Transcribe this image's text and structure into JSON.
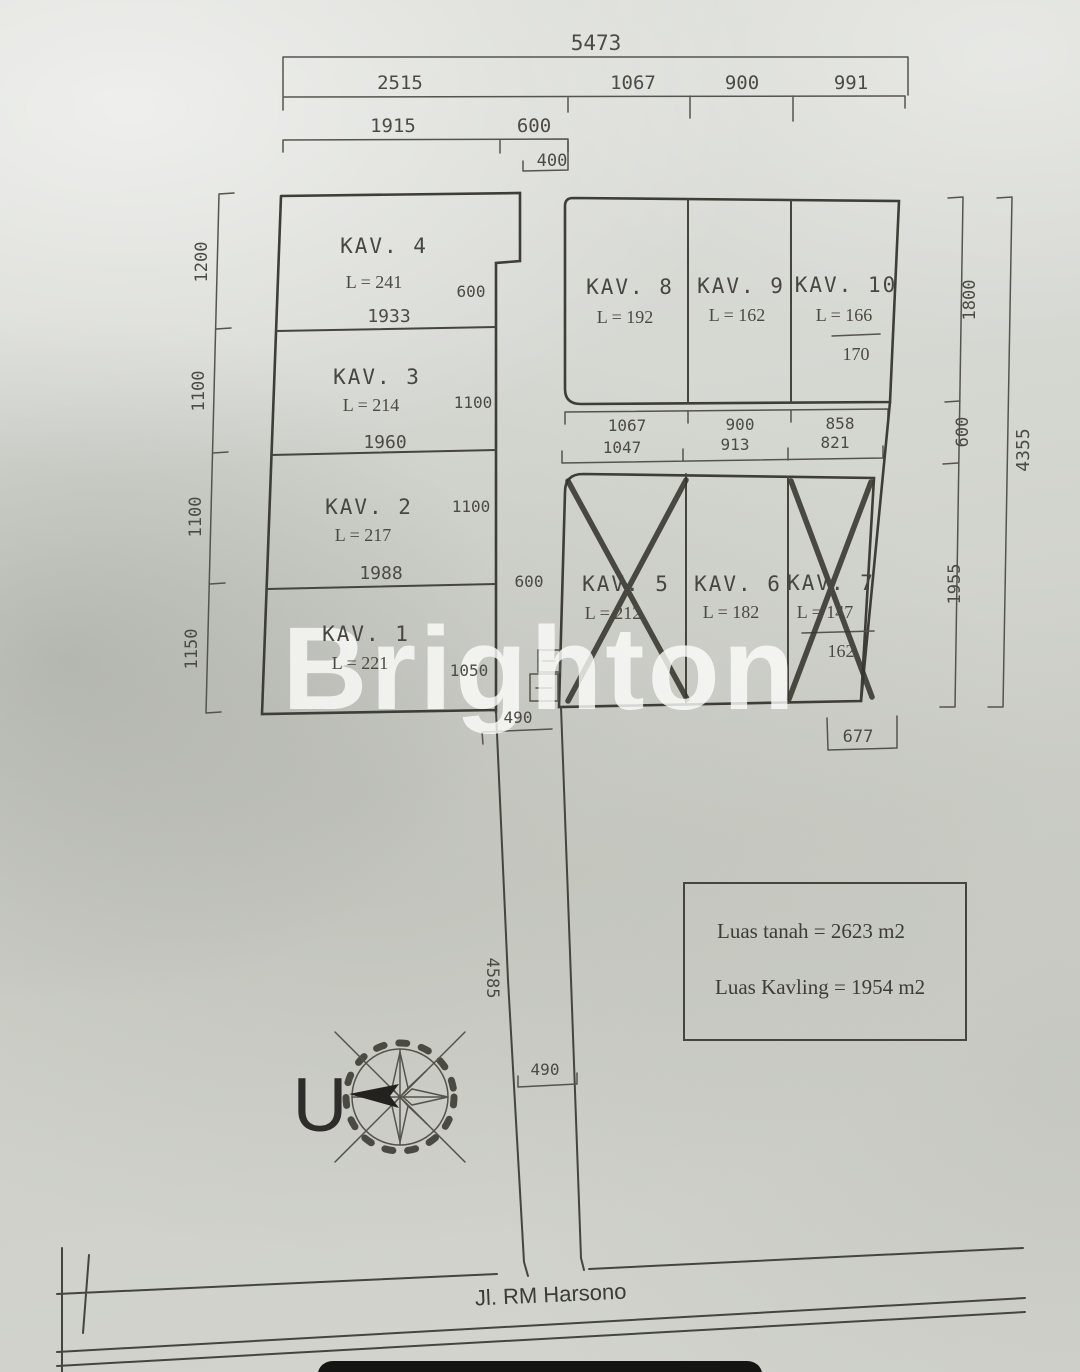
{
  "watermark": "Brighton",
  "compass": {
    "north_label": "U"
  },
  "info_box": {
    "line1": "Luas tanah = 2623 m2",
    "line2": "Luas Kavling = 1954 m2"
  },
  "main_road_label": "Jl. RM Harsono",
  "ink_color": "#45443d",
  "plots": [
    {
      "id": "kav-1",
      "title": "KAV. 1",
      "area": "L = 221",
      "crossed": false,
      "pos": {
        "tx": 366,
        "ty": 641,
        "ax": 360,
        "ay": 669
      }
    },
    {
      "id": "kav-2",
      "title": "KAV. 2",
      "area": "L = 217",
      "crossed": false,
      "pos": {
        "tx": 369,
        "ty": 514,
        "ax": 363,
        "ay": 541
      }
    },
    {
      "id": "kav-3",
      "title": "KAV. 3",
      "area": "L = 214",
      "crossed": false,
      "pos": {
        "tx": 377,
        "ty": 384,
        "ax": 371,
        "ay": 411
      }
    },
    {
      "id": "kav-4",
      "title": "KAV. 4",
      "area": "L = 241",
      "crossed": false,
      "pos": {
        "tx": 384,
        "ty": 253,
        "ax": 374,
        "ay": 288
      }
    },
    {
      "id": "kav-5",
      "title": "KAV. 5",
      "area": "L = 212",
      "crossed": true,
      "pos": {
        "tx": 626,
        "ty": 591,
        "ax": 613,
        "ay": 619
      }
    },
    {
      "id": "kav-6",
      "title": "KAV. 6",
      "area": "L = 182",
      "crossed": false,
      "pos": {
        "tx": 738,
        "ty": 591,
        "ax": 731,
        "ay": 618
      }
    },
    {
      "id": "kav-7",
      "title": "KAV. 7",
      "area": "L = 147",
      "area_alt": "162",
      "crossed": true,
      "pos": {
        "tx": 831,
        "ty": 590,
        "ax": 825,
        "ay": 618,
        "bx": 841,
        "by": 657
      }
    },
    {
      "id": "kav-8",
      "title": "KAV. 8",
      "area": "L = 192",
      "crossed": false,
      "pos": {
        "tx": 630,
        "ty": 294,
        "ax": 625,
        "ay": 323
      }
    },
    {
      "id": "kav-9",
      "title": "KAV. 9",
      "area": "L = 162",
      "crossed": false,
      "pos": {
        "tx": 741,
        "ty": 293,
        "ax": 737,
        "ay": 321
      }
    },
    {
      "id": "kav-10",
      "title": "KAV. 10",
      "area": "L = 166",
      "area_alt": "170",
      "crossed": false,
      "pos": {
        "tx": 846,
        "ty": 292,
        "ax": 844,
        "ay": 321,
        "bx": 856,
        "by": 360
      }
    }
  ],
  "dim_labels": [
    {
      "name": "dim-total-width",
      "text": "5473",
      "x": 596,
      "y": 50,
      "fs": 21
    },
    {
      "name": "dim-2515",
      "text": "2515",
      "x": 400,
      "y": 89,
      "fs": 19
    },
    {
      "name": "dim-1067-top",
      "text": "1067",
      "x": 633,
      "y": 89,
      "fs": 19
    },
    {
      "name": "dim-900-top",
      "text": "900",
      "x": 742,
      "y": 89,
      "fs": 19
    },
    {
      "name": "dim-991",
      "text": "991",
      "x": 851,
      "y": 89,
      "fs": 19
    },
    {
      "name": "dim-1915",
      "text": "1915",
      "x": 393,
      "y": 132,
      "fs": 19
    },
    {
      "name": "dim-600-top",
      "text": "600",
      "x": 534,
      "y": 132,
      "fs": 19
    },
    {
      "name": "dim-400",
      "text": "400",
      "x": 552,
      "y": 166,
      "fs": 17
    },
    {
      "name": "dim-1200-left",
      "text": "1200",
      "x": 207,
      "y": 262,
      "fs": 17,
      "rot": -90
    },
    {
      "name": "dim-1100-left-a",
      "text": "1100",
      "x": 204,
      "y": 391,
      "fs": 17,
      "rot": -90
    },
    {
      "name": "dim-1100-left-b",
      "text": "1100",
      "x": 201,
      "y": 517,
      "fs": 17,
      "rot": -90
    },
    {
      "name": "dim-1150-left",
      "text": "1150",
      "x": 197,
      "y": 649,
      "fs": 17,
      "rot": -90
    },
    {
      "name": "dim-1800-right",
      "text": "1800",
      "x": 975,
      "y": 300,
      "fs": 17,
      "rot": -90
    },
    {
      "name": "dim-600-right",
      "text": "600",
      "x": 968,
      "y": 432,
      "fs": 17,
      "rot": -90
    },
    {
      "name": "dim-1955-right",
      "text": "1955",
      "x": 960,
      "y": 584,
      "fs": 17,
      "rot": -90
    },
    {
      "name": "dim-4355",
      "text": "4355",
      "x": 1029,
      "y": 450,
      "fs": 18,
      "rot": -90
    },
    {
      "name": "dim-600-kav4",
      "text": "600",
      "x": 471,
      "y": 297,
      "fs": 16
    },
    {
      "name": "dim-1933",
      "text": "1933",
      "x": 389,
      "y": 322,
      "fs": 18
    },
    {
      "name": "dim-1100-kav3",
      "text": "1100",
      "x": 473,
      "y": 408,
      "fs": 16
    },
    {
      "name": "dim-1960",
      "text": "1960",
      "x": 385,
      "y": 448,
      "fs": 18
    },
    {
      "name": "dim-1100-kav2",
      "text": "1100",
      "x": 471,
      "y": 512,
      "fs": 16
    },
    {
      "name": "dim-1988",
      "text": "1988",
      "x": 381,
      "y": 579,
      "fs": 18
    },
    {
      "name": "dim-600-corridor",
      "text": "600",
      "x": 529,
      "y": 587,
      "fs": 16
    },
    {
      "name": "dim-1050",
      "text": "1050",
      "x": 469,
      "y": 676,
      "fs": 16
    },
    {
      "name": "dim-1067-mid",
      "text": "1067",
      "x": 627,
      "y": 431,
      "fs": 16
    },
    {
      "name": "dim-900-mid",
      "text": "900",
      "x": 740,
      "y": 430,
      "fs": 16
    },
    {
      "name": "dim-858",
      "text": "858",
      "x": 840,
      "y": 429,
      "fs": 16
    },
    {
      "name": "dim-1047",
      "text": "1047",
      "x": 622,
      "y": 453,
      "fs": 16
    },
    {
      "name": "dim-913",
      "text": "913",
      "x": 735,
      "y": 450,
      "fs": 16
    },
    {
      "name": "dim-821",
      "text": "821",
      "x": 835,
      "y": 448,
      "fs": 16
    },
    {
      "name": "dim-677",
      "text": "677",
      "x": 858,
      "y": 742,
      "fs": 17
    },
    {
      "name": "dim-490-top",
      "text": "490",
      "x": 518,
      "y": 723,
      "fs": 16
    },
    {
      "name": "dim-4585",
      "text": "4585",
      "x": 487,
      "y": 978,
      "fs": 17,
      "rot": 90
    },
    {
      "name": "dim-490-bottom",
      "text": "490",
      "x": 545,
      "y": 1075,
      "fs": 16
    }
  ]
}
